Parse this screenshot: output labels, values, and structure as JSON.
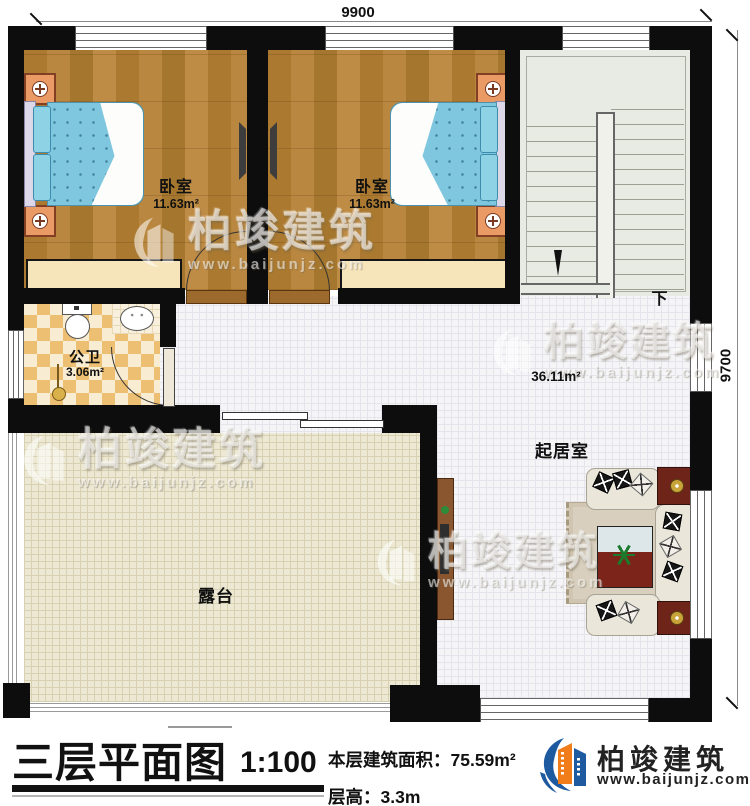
{
  "plan": {
    "dimensions": {
      "top": "9900",
      "right": "9700"
    },
    "rooms": {
      "bedroom1": {
        "name": "卧室",
        "area": "11.63m²"
      },
      "bedroom2": {
        "name": "卧室",
        "area": "11.63m²"
      },
      "bathroom": {
        "name": "公卫",
        "area": "3.06m²"
      },
      "living_room": {
        "name": "起居室",
        "area": "36.11m²"
      },
      "terrace": {
        "name": "露台"
      },
      "stairs": {
        "direction_label": "下"
      }
    }
  },
  "watermark": {
    "name": "柏竣建筑",
    "url": "www.baijunjz.com"
  },
  "title_block": {
    "title": "三层平面图",
    "scale": "1:100",
    "area_label": "本层建筑面积：",
    "area_value": "75.59m²",
    "height_label": "层高：",
    "height_value": "3.3m",
    "brand_name": "柏竣建筑",
    "brand_url": "www.baijunjz.com"
  },
  "icons": {
    "brand_logo": "baijun-building-logo",
    "watermark_logo": "baijun-building-logo",
    "stair_arrow": "down-arrow",
    "bed_lamp": "table-lamp",
    "plant": "potted-plant"
  },
  "colors": {
    "wall": "#0d0d0d",
    "wood_floor": "#b2803a",
    "tile_floor": "#f5f5f7",
    "terrace_floor": "#ece8d3",
    "bath_tile": "#edbf72",
    "bed_blue": "#7fc6df",
    "brand_blue": "#1e5aa0",
    "brand_orange": "#f07c1a"
  }
}
